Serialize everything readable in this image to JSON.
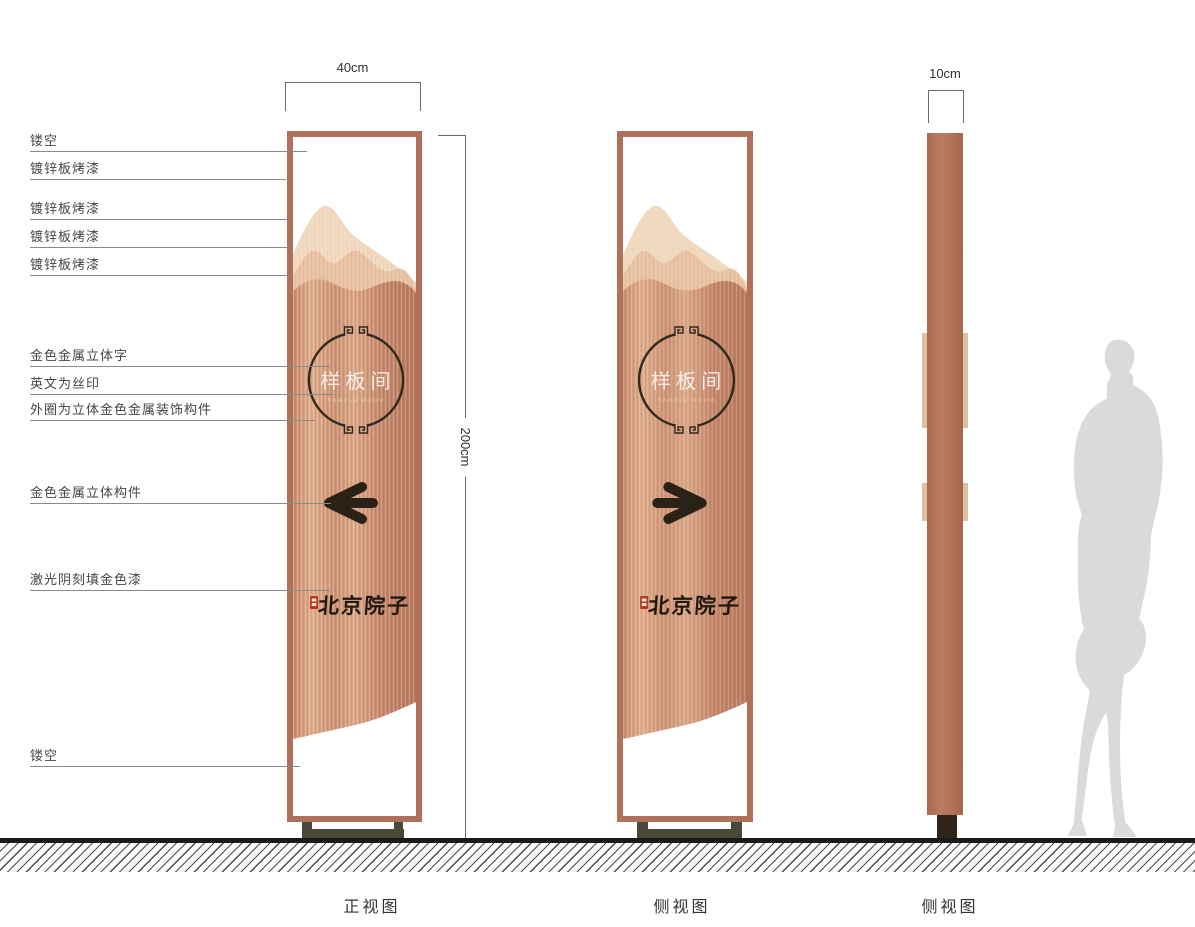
{
  "dimensions": {
    "front_width": "40cm",
    "profile_width": "10cm",
    "height": "200cm"
  },
  "annotations": [
    {
      "label": "镂空"
    },
    {
      "label": "镀锌板烤漆"
    },
    {
      "label": "镀锌板烤漆"
    },
    {
      "label": "镀锌板烤漆"
    },
    {
      "label": "镀锌板烤漆"
    },
    {
      "label": "金色金属立体字"
    },
    {
      "label": "英文为丝印"
    },
    {
      "label": "外圈为立体金色金属装饰构件"
    },
    {
      "label": "金色金属立体构件"
    },
    {
      "label": "激光阴刻填金色漆"
    },
    {
      "label": "镂空"
    }
  ],
  "sign": {
    "room_name": "样板间",
    "english_subtext": "SAMPLE ROOM",
    "brand_name": "北京院子"
  },
  "view_labels": {
    "front": "正视图",
    "side": "侧视图",
    "profile": "侧视图"
  },
  "colors": {
    "frame": "#b0715a",
    "copper_light": "#e0ad8c",
    "copper_dark": "#b8795e",
    "mountain_back": "#f1d9c0",
    "mountain_front": "#e9c2a3",
    "emblem_dark": "#32281e",
    "seal_red": "#b23b28",
    "base_olive": "#4a4837",
    "silhouette_gray": "#dadada"
  }
}
